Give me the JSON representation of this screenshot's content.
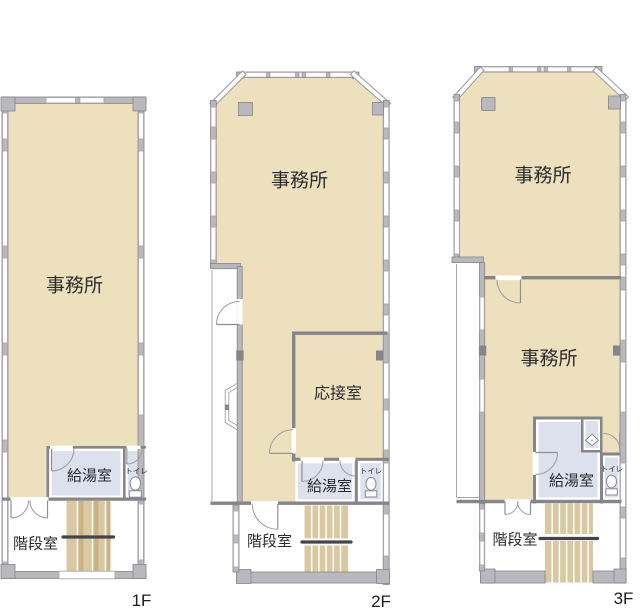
{
  "colors": {
    "office_fill": "#ece0bd",
    "wet_fill": "#dce1ed",
    "wall_fill": "#b9b9bd",
    "wall_stroke": "#85858b",
    "interior_wall": "#85858c",
    "window_line": "#a8a8af",
    "stair_fill": "#d9c8a0",
    "stair_dark": "#cbb384",
    "handrail": "#44444a",
    "door_line": "#9b9ba1",
    "label_color": "#2b2b2e",
    "floor_label_color": "#1c1c1c"
  },
  "floors": [
    {
      "name": "1F",
      "office": "事務所",
      "kitchen": "給湯室",
      "toilet": "トイレ",
      "stairwell": "階段室"
    },
    {
      "name": "2F",
      "office": "事務所",
      "reception": "応接室",
      "kitchen": "給湯室",
      "toilet": "トイレ",
      "stairwell": "階段室"
    },
    {
      "name": "3F",
      "office_upper": "事務所",
      "office_lower": "事務所",
      "kitchen": "給湯室",
      "toilet": "トイレ",
      "stairwell": "階段室"
    }
  ]
}
